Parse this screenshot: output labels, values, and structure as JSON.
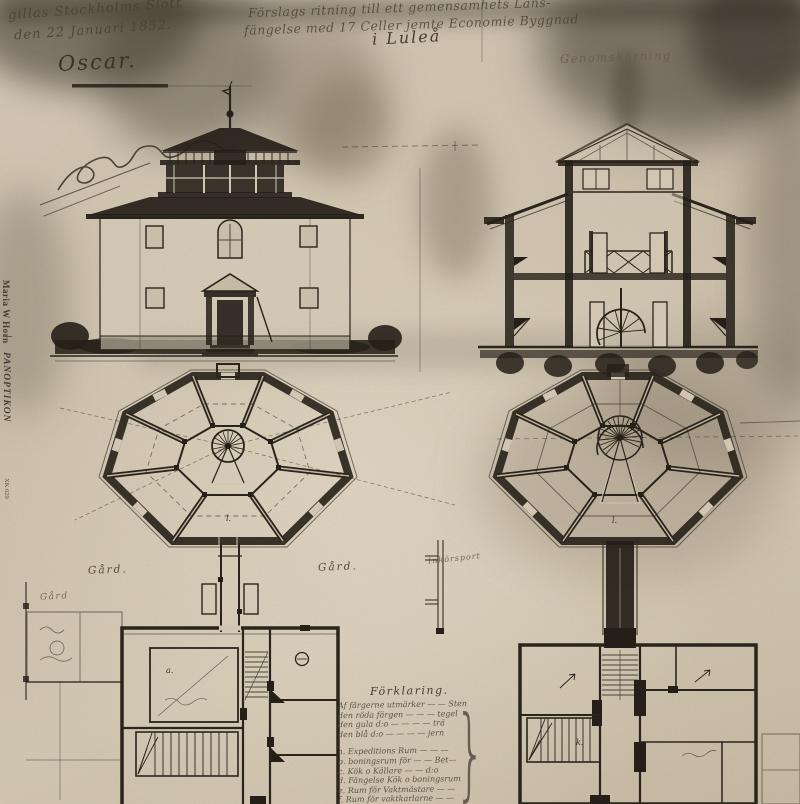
{
  "artwork": {
    "approval": {
      "line1": "gillas Stockholms Slott",
      "line2": "den 22 Januari 1852.",
      "signature": "Oscar."
    },
    "title": {
      "line1": "Förslags ritning till ett gemensamhets Läns-",
      "line2": "fängelse med 17 Celler jemte Economie Byggnad",
      "line3": "i  Luleå"
    },
    "section_caption": "Genomskärning",
    "spine": {
      "artist": "Maria W Horn",
      "album": "PANOPTIKON",
      "catalog": "XK 029"
    },
    "site_labels": {
      "yard_left": "Gård.",
      "yard_right": "Gård.",
      "yard_far_left": "Gård",
      "gate_label": "Inkörsport"
    },
    "plan_letters": {
      "left_cell": "l.",
      "right_cell": "l.",
      "room_a": "a.",
      "room_k": "k."
    },
    "legend": {
      "title": "Förklaring.",
      "lines": [
        "Af färgerne utmärker — — Sten",
        "den röda färgen — — — tegel",
        "den gula  d:o — — — — trä",
        "den blå  d:o — — — — jern",
        "a. Expeditions Rum — — —",
        "b. boningsrum för — — Bet—",
        "c. Kök o Källare — — d:o",
        "d. Fängelse Kök o boningsrum",
        "e. Rum för Vaktmästare — —",
        "f. Rum för vaktkarlarne — —"
      ]
    }
  }
}
